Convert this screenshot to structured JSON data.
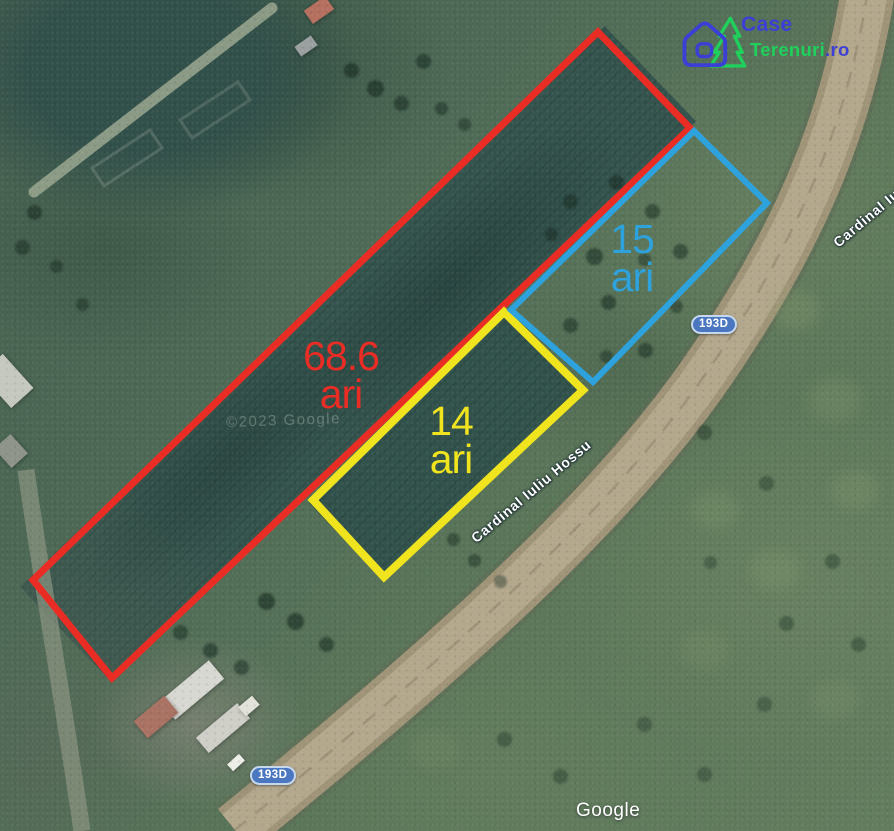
{
  "brand": {
    "word1": "Case",
    "word2": "Terenuri",
    "word3": ".ro",
    "blue": "#3b3fd6",
    "green": "#1fd05c"
  },
  "parcels": [
    {
      "label": "red",
      "area": "68.6",
      "unit": "ari",
      "color": "#ea2d24"
    },
    {
      "label": "yellow",
      "area": "14",
      "unit": "ari",
      "color": "#f0e41f"
    },
    {
      "label": "blue",
      "area": "15",
      "unit": "ari",
      "color": "#2da2dc"
    }
  ],
  "map": {
    "road_name": "Cardinal Iuliu Hossu",
    "route_badge": "193D",
    "attribution": "Google",
    "copyright_watermark": "©2023 Google"
  }
}
